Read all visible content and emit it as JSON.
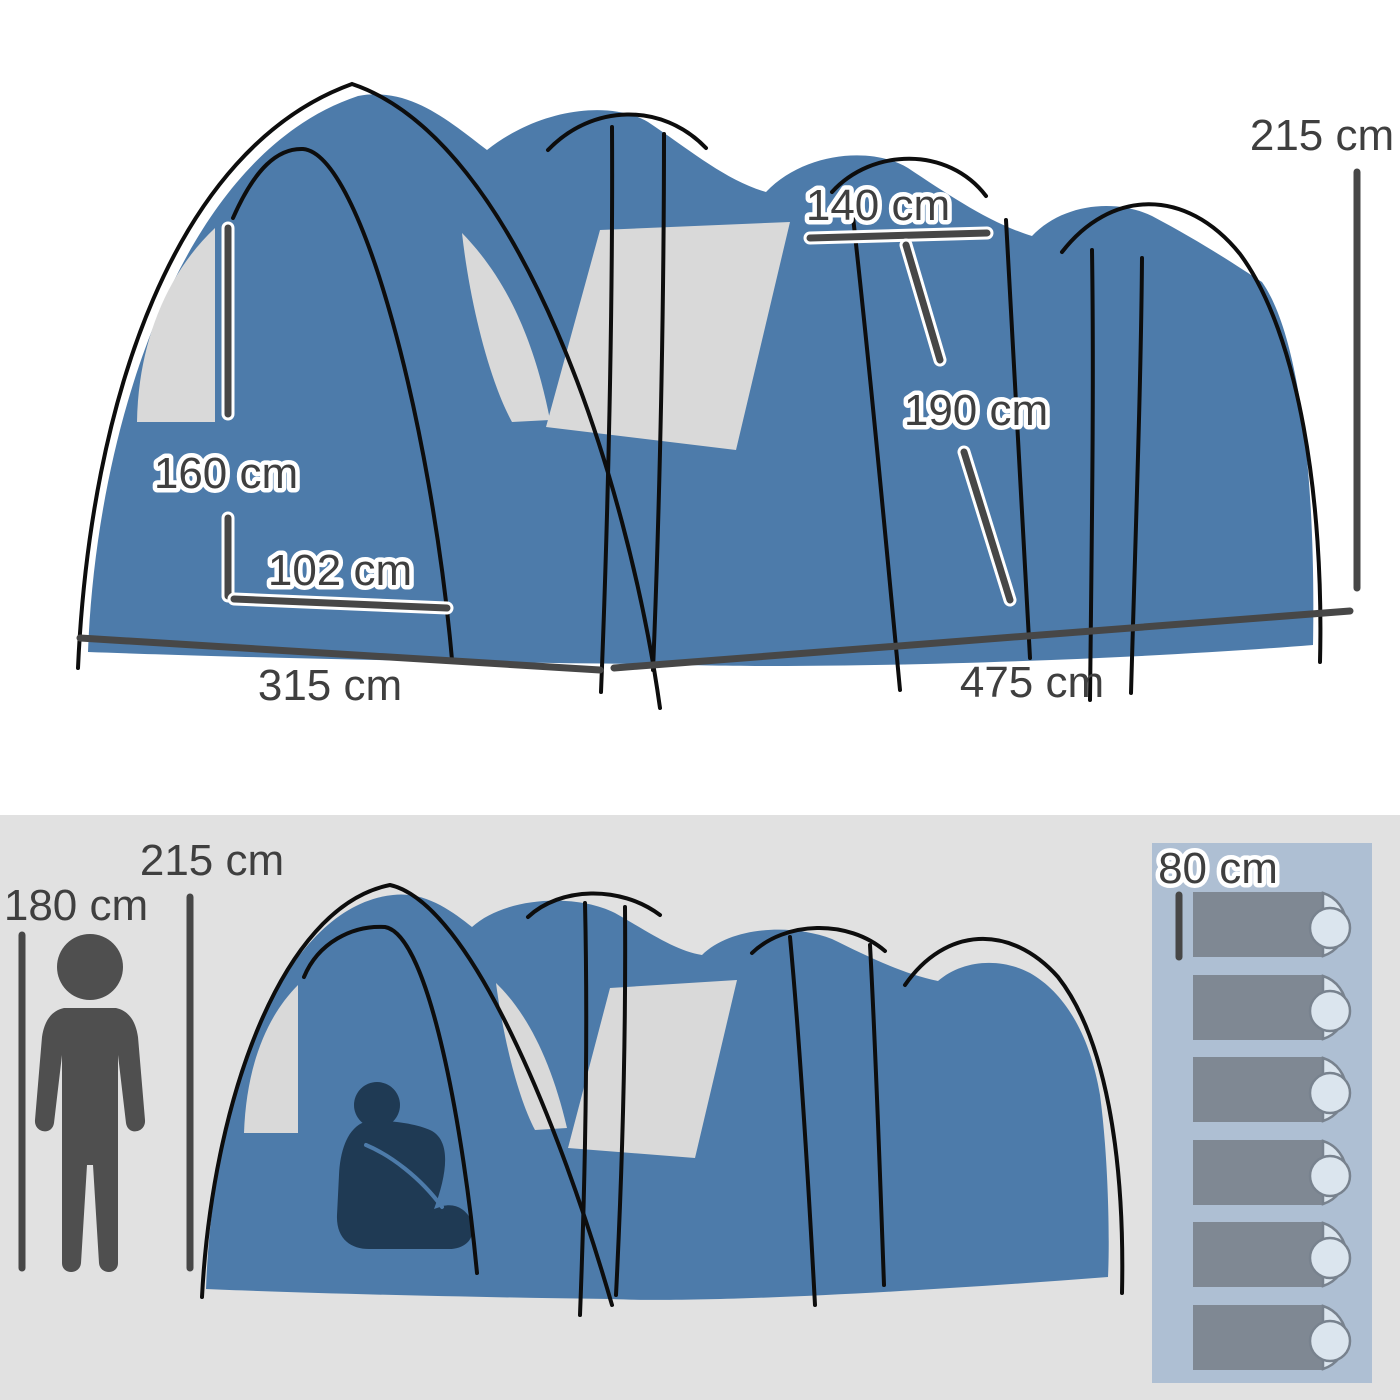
{
  "title": "Tunnel tent dimension diagram",
  "top_diagram": {
    "labels": {
      "total_height": "215 cm",
      "inner_width": "140 cm",
      "inner_height": "190 cm",
      "door_height": "160 cm",
      "door_width": "102 cm",
      "front_width": "315 cm",
      "side_length": "475 cm"
    }
  },
  "bottom_diagram": {
    "labels": {
      "person_height": "180 cm",
      "tent_height": "215 cm",
      "sleeping_bag_width": "80 cm"
    },
    "sleeping_bag_count": 6,
    "icons": [
      "standing-person-icon",
      "sitting-person-icon",
      "sleeping-bag-icon"
    ]
  },
  "colors": {
    "tent_blue": "#4d7baa",
    "window_gray": "#d9d9d9",
    "pole_black": "#0d0d0d",
    "dimension_gray": "#474747",
    "text_gray": "#3f3f3f",
    "top_background": "#ffffff",
    "bottom_background": "#e1e1e1",
    "panel_blue": "#aebfd3",
    "sleeping_bag_gray": "#7f8893",
    "sleeping_bag_end": "#dbe5ee",
    "standing_person_gray": "#4f4f4f",
    "sitting_person_navy": "#1f3a54"
  }
}
